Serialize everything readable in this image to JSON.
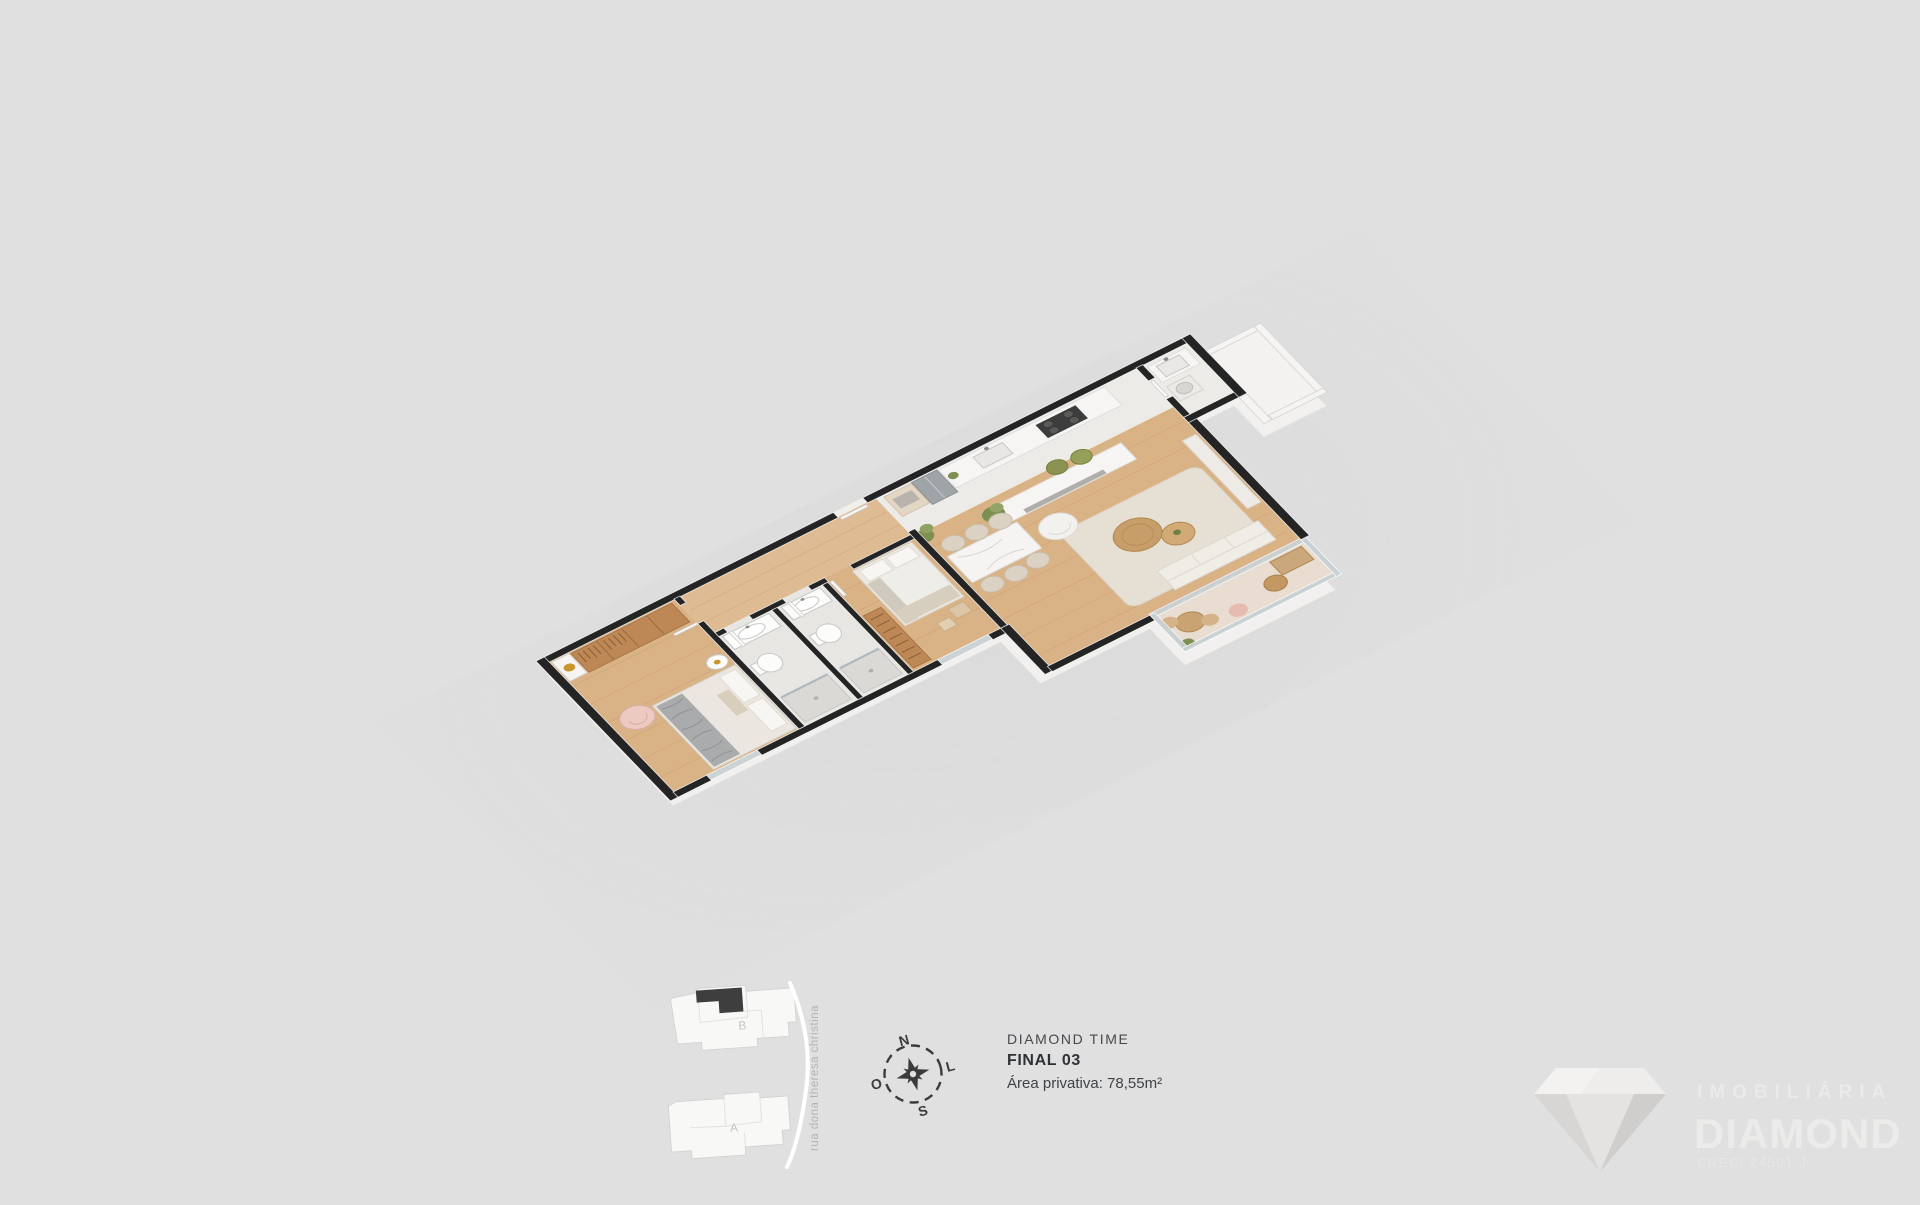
{
  "background_color": "#e0e0e0",
  "unit_info": {
    "project_name": "DIAMOND TIME",
    "unit_label": "FINAL 03",
    "private_area": "Área privativa: 78,55m²"
  },
  "compass": {
    "north": "N",
    "south": "S",
    "east": "L",
    "west": "O"
  },
  "site_plan": {
    "tower_b_label": "B",
    "tower_a_label": "A",
    "street_name": "rua dona theresa christina",
    "highlight_color": "#3e3e3e"
  },
  "watermark": {
    "tagline": "IMOBILIÁRIA",
    "brand": "DIAMOND",
    "registration": "CRECI 24501-J"
  },
  "floorplan_colors": {
    "wall": "#242424",
    "wood_floor": "#d9b286",
    "kitchen_tile": "#edebe8",
    "bath_tile": "#e8e6e2",
    "wardrobe_wood": "#bd8756",
    "glass": "#c7d1d4",
    "plant_green": "#7d9052",
    "armchair_pink": "#ecc9c1",
    "stool_olive": "#8b9252"
  }
}
